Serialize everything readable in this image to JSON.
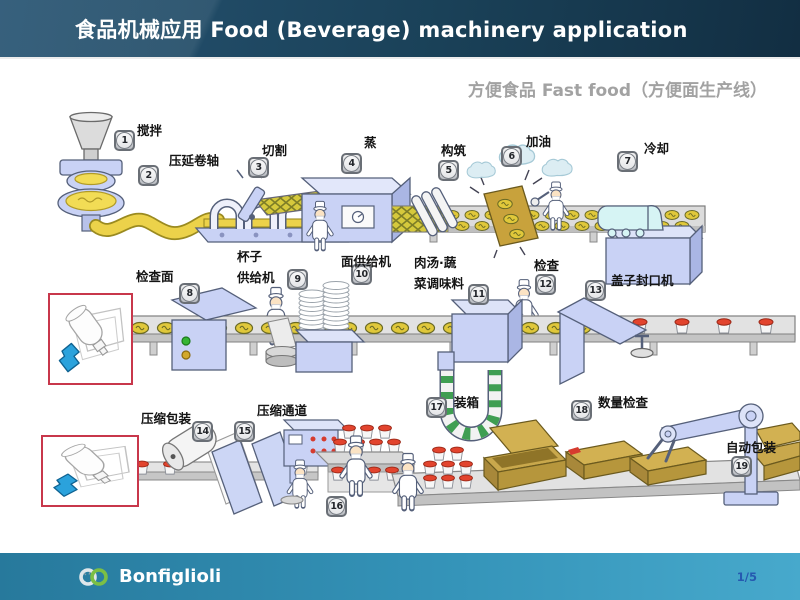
{
  "header": {
    "title": "食品机械应用  Food (Beverage) machinery application"
  },
  "subtitle": "方便食品 Fast food（方便面生产线）",
  "stations": [
    {
      "num": "1",
      "label": "搅拌"
    },
    {
      "num": "2",
      "label": "压延卷轴"
    },
    {
      "num": "3",
      "label": "切割"
    },
    {
      "num": "4",
      "label": "蒸"
    },
    {
      "num": "5",
      "label": "构筑"
    },
    {
      "num": "6",
      "label": "加油"
    },
    {
      "num": "7",
      "label": "冷却"
    },
    {
      "num": "8",
      "label": "检查面"
    },
    {
      "num": "9",
      "label": "杯子\n供给机"
    },
    {
      "num": "10",
      "label": "面供给机"
    },
    {
      "num": "11",
      "label": "肉汤·蔬\n菜调味料"
    },
    {
      "num": "12",
      "label": "检查"
    },
    {
      "num": "13",
      "label": "盖子封口机"
    },
    {
      "num": "14",
      "label": "压缩包装"
    },
    {
      "num": "15",
      "label": "压缩通道"
    },
    {
      "num": "16",
      "label": ""
    },
    {
      "num": "17",
      "label": "装箱"
    },
    {
      "num": "18",
      "label": "数量检查"
    },
    {
      "num": "19",
      "label": "自动包装"
    }
  ],
  "footer": {
    "brand": "Bonfiglioli",
    "page": "1/5"
  },
  "colors": {
    "header_bg": "#1a4158",
    "subtitle_gray": "#a2a2a2",
    "footer_teal_left": "#27799c",
    "footer_teal_right": "#47a9cc",
    "page_number_blue": "#2559b0",
    "inset_border_red": "#c8374b",
    "machine_blue": "#c9d2f5",
    "noodle_yellow": "#e0c83a",
    "carton_tan": "#c9a84c",
    "lid_red": "#e2442e",
    "gearmotor_blue": "#2ba2dc"
  }
}
